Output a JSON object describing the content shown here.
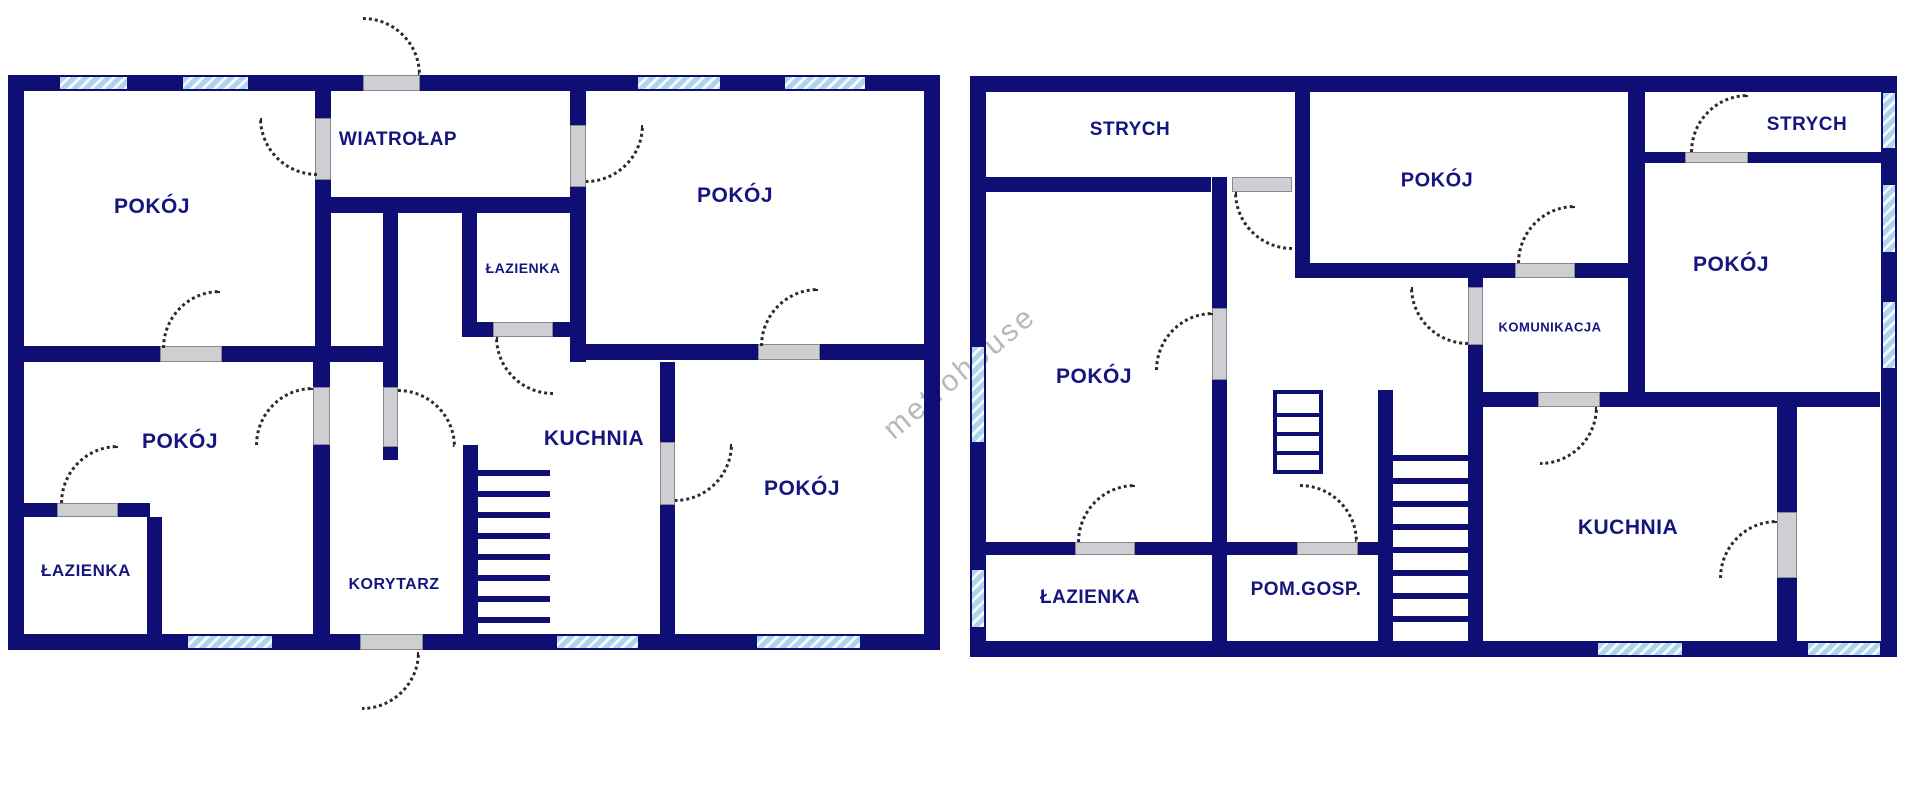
{
  "canvas": {
    "width": 1920,
    "height": 789
  },
  "colors": {
    "wall": "#0e0e74",
    "label": "#15157f",
    "window_fill": "#aed3ea",
    "window_stripe": "#f2fafd",
    "door_jamb": "#cfcfd3",
    "door_jamb_edge": "#8a8a8e",
    "door_arc": "#2a2a2a"
  },
  "watermark": {
    "text": "metrohouse",
    "cx": 960,
    "cy": 373,
    "rotation_deg": -40
  },
  "plans": [
    {
      "id": "left-floor",
      "rooms": [
        {
          "label": "POKÓJ",
          "cx": 152,
          "cy": 207,
          "font_size": 21
        },
        {
          "label": "WIATROŁAP",
          "cx": 398,
          "cy": 140,
          "font_size": 19
        },
        {
          "label": "POKÓJ",
          "cx": 735,
          "cy": 196,
          "font_size": 21
        },
        {
          "label": "ŁAZIENKA",
          "cx": 523,
          "cy": 268,
          "font_size": 14
        },
        {
          "label": "KUCHNIA",
          "cx": 594,
          "cy": 439,
          "font_size": 21
        },
        {
          "label": "POKÓJ",
          "cx": 180,
          "cy": 442,
          "font_size": 21
        },
        {
          "label": "ŁAZIENKA",
          "cx": 86,
          "cy": 571,
          "font_size": 17
        },
        {
          "label": "KORYTARZ",
          "cx": 394,
          "cy": 585,
          "font_size": 16
        },
        {
          "label": "POKÓJ",
          "cx": 802,
          "cy": 489,
          "font_size": 21
        }
      ],
      "walls": [
        [
          8,
          75,
          932,
          16
        ],
        [
          8,
          634,
          932,
          16
        ],
        [
          8,
          75,
          16,
          575
        ],
        [
          924,
          75,
          16,
          575
        ],
        [
          315,
          91,
          16,
          271
        ],
        [
          570,
          91,
          16,
          271
        ],
        [
          331,
          197,
          254,
          16
        ],
        [
          383,
          213,
          15,
          247
        ],
        [
          462,
          213,
          15,
          124
        ],
        [
          462,
          322,
          123,
          15
        ],
        [
          8,
          346,
          390,
          16
        ],
        [
          577,
          344,
          363,
          16
        ],
        [
          313,
          346,
          17,
          304
        ],
        [
          463,
          445,
          15,
          205
        ],
        [
          660,
          362,
          15,
          288
        ],
        [
          20,
          503,
          130,
          14
        ],
        [
          147,
          517,
          15,
          117
        ]
      ],
      "windows": [
        [
          60,
          77,
          67,
          12
        ],
        [
          183,
          77,
          65,
          12
        ],
        [
          638,
          77,
          82,
          12
        ],
        [
          785,
          77,
          80,
          12
        ],
        [
          188,
          636,
          84,
          12
        ],
        [
          557,
          636,
          81,
          12
        ],
        [
          757,
          636,
          103,
          12
        ]
      ],
      "doors": [
        {
          "jamb": [
            363,
            75,
            57,
            16
          ],
          "arc": [
            363,
            17,
            58
          ],
          "bulge": "tr"
        },
        {
          "jamb": [
            315,
            118,
            16,
            62
          ],
          "arc": [
            259,
            118,
            58
          ],
          "bulge": "bl"
        },
        {
          "jamb": [
            570,
            125,
            16,
            62
          ],
          "arc": [
            586,
            125,
            58
          ],
          "bulge": "br"
        },
        {
          "jamb": [
            493,
            322,
            60,
            15
          ],
          "arc": [
            495,
            337,
            58
          ],
          "bulge": "bl"
        },
        {
          "jamb": [
            383,
            387,
            15,
            60
          ],
          "arc": [
            398,
            389,
            58
          ],
          "bulge": "tr"
        },
        {
          "jamb": [
            313,
            387,
            17,
            58
          ],
          "arc": [
            255,
            387,
            58
          ],
          "bulge": "tl"
        },
        {
          "jamb": [
            57,
            503,
            61,
            14
          ],
          "arc": [
            60,
            445,
            58
          ],
          "bulge": "tl"
        },
        {
          "jamb": [
            660,
            442,
            15,
            63
          ],
          "arc": [
            675,
            444,
            58
          ],
          "bulge": "br"
        },
        {
          "jamb": [
            758,
            344,
            62,
            16
          ],
          "arc": [
            760,
            288,
            58
          ],
          "bulge": "tl"
        },
        {
          "jamb": [
            160,
            346,
            62,
            16
          ],
          "arc": [
            162,
            290,
            58
          ],
          "bulge": "tl"
        },
        {
          "jamb": [
            360,
            634,
            63,
            16
          ],
          "arc": [
            362,
            652,
            58
          ],
          "bulge": "br"
        }
      ],
      "stairs": [
        {
          "x": 478,
          "y": 470,
          "w": 72,
          "count": 8,
          "gap": 21,
          "thick": 6
        }
      ],
      "ladders": []
    },
    {
      "id": "right-floor",
      "rooms": [
        {
          "label": "STRYCH",
          "cx": 1130,
          "cy": 130,
          "font_size": 19
        },
        {
          "label": "POKÓJ",
          "cx": 1437,
          "cy": 181,
          "font_size": 20
        },
        {
          "label": "STRYCH",
          "cx": 1807,
          "cy": 125,
          "font_size": 19
        },
        {
          "label": "POKÓJ",
          "cx": 1731,
          "cy": 265,
          "font_size": 21
        },
        {
          "label": "KOMUNIKACJA",
          "cx": 1550,
          "cy": 327,
          "font_size": 13
        },
        {
          "label": "POKÓJ",
          "cx": 1094,
          "cy": 377,
          "font_size": 21
        },
        {
          "label": "ŁAZIENKA",
          "cx": 1090,
          "cy": 598,
          "font_size": 19
        },
        {
          "label": "POM.GOSP.",
          "cx": 1306,
          "cy": 590,
          "font_size": 19
        },
        {
          "label": "KUCHNIA",
          "cx": 1628,
          "cy": 528,
          "font_size": 21
        }
      ],
      "walls": [
        [
          970,
          76,
          927,
          16
        ],
        [
          970,
          641,
          927,
          16
        ],
        [
          970,
          76,
          16,
          581
        ],
        [
          1881,
          76,
          16,
          581
        ],
        [
          986,
          177,
          225,
          15
        ],
        [
          1212,
          177,
          15,
          480
        ],
        [
          1295,
          92,
          15,
          178
        ],
        [
          1295,
          263,
          333,
          15
        ],
        [
          1468,
          277,
          15,
          364
        ],
        [
          1628,
          76,
          17,
          331
        ],
        [
          1645,
          152,
          236,
          11
        ],
        [
          1483,
          392,
          397,
          15
        ],
        [
          1378,
          390,
          15,
          251
        ],
        [
          1227,
          542,
          166,
          13
        ],
        [
          986,
          542,
          226,
          13
        ],
        [
          1777,
          407,
          20,
          234
        ]
      ],
      "windows": [
        [
          972,
          347,
          12,
          95
        ],
        [
          972,
          570,
          12,
          57
        ],
        [
          1883,
          93,
          12,
          55
        ],
        [
          1883,
          185,
          12,
          67
        ],
        [
          1883,
          302,
          12,
          66
        ],
        [
          1598,
          643,
          84,
          12
        ],
        [
          1808,
          643,
          72,
          12
        ]
      ],
      "doors": [
        {
          "jamb": [
            1232,
            177,
            60,
            15
          ],
          "arc": [
            1234,
            192,
            58
          ],
          "bulge": "bl"
        },
        {
          "jamb": [
            1212,
            308,
            15,
            72
          ],
          "arc": [
            1155,
            312,
            58
          ],
          "bulge": "tl"
        },
        {
          "jamb": [
            1075,
            542,
            60,
            13
          ],
          "arc": [
            1077,
            484,
            58
          ],
          "bulge": "tl"
        },
        {
          "jamb": [
            1297,
            542,
            61,
            13
          ],
          "arc": [
            1300,
            484,
            58
          ],
          "bulge": "tr"
        },
        {
          "jamb": [
            1468,
            287,
            15,
            58
          ],
          "arc": [
            1410,
            287,
            58
          ],
          "bulge": "bl"
        },
        {
          "jamb": [
            1515,
            263,
            60,
            15
          ],
          "arc": [
            1517,
            205,
            58
          ],
          "bulge": "tl"
        },
        {
          "jamb": [
            1538,
            392,
            62,
            15
          ],
          "arc": [
            1540,
            407,
            58
          ],
          "bulge": "br"
        },
        {
          "jamb": [
            1685,
            152,
            63,
            11
          ],
          "arc": [
            1690,
            94,
            58
          ],
          "bulge": "tl"
        },
        {
          "jamb": [
            1777,
            512,
            20,
            66
          ],
          "arc": [
            1719,
            520,
            58
          ],
          "bulge": "tl"
        }
      ],
      "stairs": [
        {
          "x": 1393,
          "y": 455,
          "w": 75,
          "count": 8,
          "gap": 23,
          "thick": 6
        }
      ],
      "ladders": [
        {
          "x": 1273,
          "y": 390,
          "w": 50,
          "h": 84,
          "rungs": 3
        }
      ]
    }
  ]
}
